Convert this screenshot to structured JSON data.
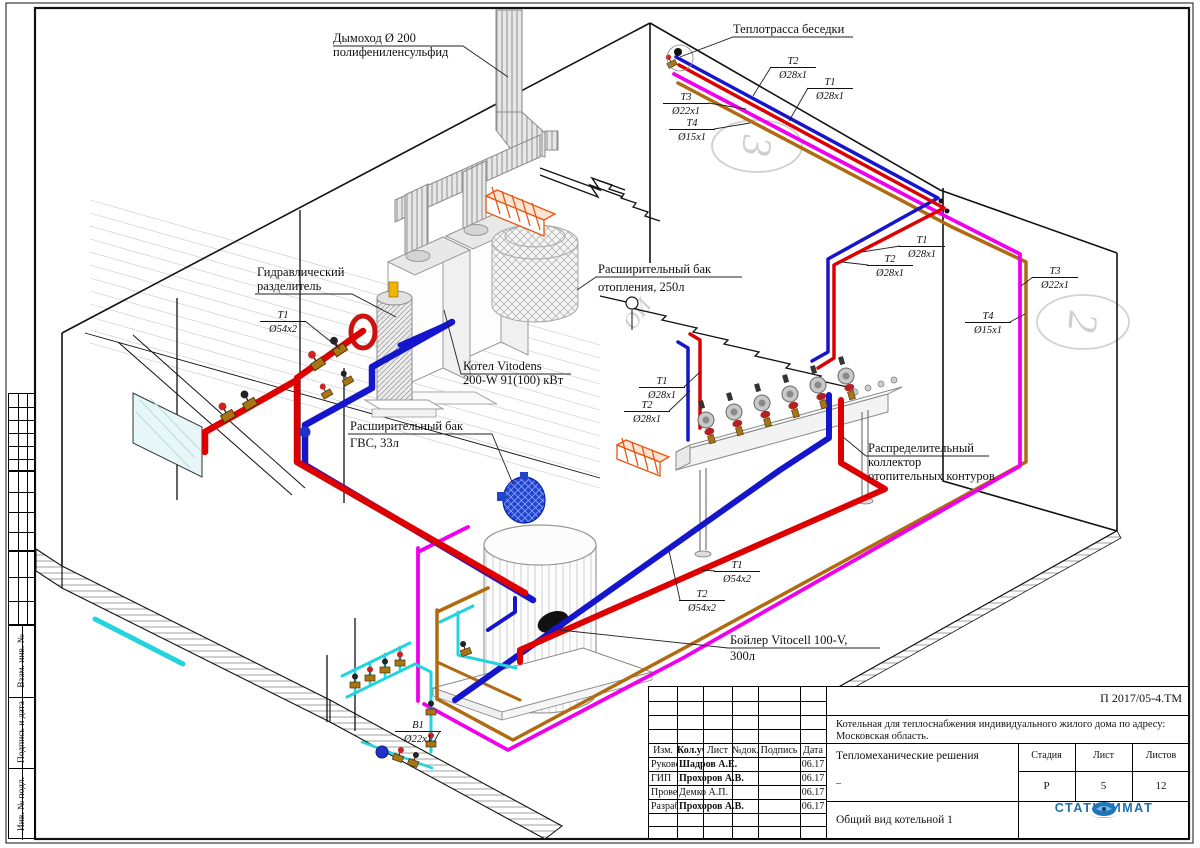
{
  "labels": {
    "chimney": [
      "Дымоход Ø 200",
      "полифениленсульфид"
    ],
    "teplotrassa": "Теплотрасса беседки",
    "separator": [
      "Гидравлический",
      "разделитель"
    ],
    "boiler": [
      "Котел Vitodens",
      "200-W 91(100) кВт"
    ],
    "exp_tank_heating": [
      "Расширительный бак",
      "отопления, 250л"
    ],
    "exp_tank_dhw": [
      "Расширительный бак",
      "ГВС, 33л"
    ],
    "manifold": [
      "Распределительный",
      "коллектор",
      "отопительных контуров"
    ],
    "dhw_tank": [
      "Бойлер Vitocell 100-V,",
      "300л"
    ]
  },
  "tags": [
    {
      "name": "Т2",
      "size": "Ø28x1"
    },
    {
      "name": "Т1",
      "size": "Ø28x1"
    },
    {
      "name": "Т3",
      "size": "Ø22x1"
    },
    {
      "name": "Т4",
      "size": "Ø15x1"
    },
    {
      "name": "Т1",
      "size": "Ø28x1"
    },
    {
      "name": "Т2",
      "size": "Ø28x1"
    },
    {
      "name": "Т3",
      "size": "Ø22x1"
    },
    {
      "name": "Т4",
      "size": "Ø15x1"
    },
    {
      "name": "Т1",
      "size": "Ø54x2"
    },
    {
      "name": "Т1",
      "size": "Ø28x1"
    },
    {
      "name": "Т2",
      "size": "Ø28x1"
    },
    {
      "name": "Т1",
      "size": "Ø54x2"
    },
    {
      "name": "Т2",
      "size": "Ø54x2"
    },
    {
      "name": "В1",
      "size": "Ø22x1"
    }
  ],
  "watermarks": {
    "zone2": "2",
    "zone3": "3",
    "misc": "ОИ"
  },
  "stamp": {
    "doc_number": "П 2017/05-4.ТМ",
    "project_line1": "Котельная для теплоснабжения индивидуального жилого дома по адресу:",
    "project_line2": "Московская область.",
    "section": "Тепломеханические решения",
    "section2": "–",
    "drawing_title": "Общий вид котельной 1",
    "stage_label": "Стадия",
    "sheet_label": "Лист",
    "sheets_label": "Листов",
    "stage": "Р",
    "sheet": "5",
    "sheets": "12",
    "header": {
      "izm": "Изм.",
      "kol": "Кол.уч.",
      "list": "Лист",
      "doc": "№док.",
      "sign": "Подпись",
      "date": "Дата"
    },
    "rows": [
      {
        "role": "Руководит.",
        "name": "Шадров А.Е.",
        "date": "06.17"
      },
      {
        "role": "ГИП",
        "name": "Прохоров А.В.",
        "date": "06.17"
      },
      {
        "role": "Проверил",
        "name": "Демко А.П.",
        "date": "06.17"
      },
      {
        "role": "Разработал",
        "name": "Прохоров А.В.",
        "date": "06.17"
      }
    ],
    "logo": "СТАТКЛИМАТ"
  },
  "side_strip": {
    "labels": [
      "Взам. инв. №",
      "Подпись и дата",
      "Инв. № подл."
    ]
  },
  "colors": {
    "t1": "#dd0000",
    "t2": "#1515cc",
    "t3": "#ee00ee",
    "t4": "#b06a10",
    "b1": "#23d3dd",
    "radiator": "#e85510",
    "logo_blue": "#1b6fae",
    "logo_green": "#3a9c35"
  }
}
